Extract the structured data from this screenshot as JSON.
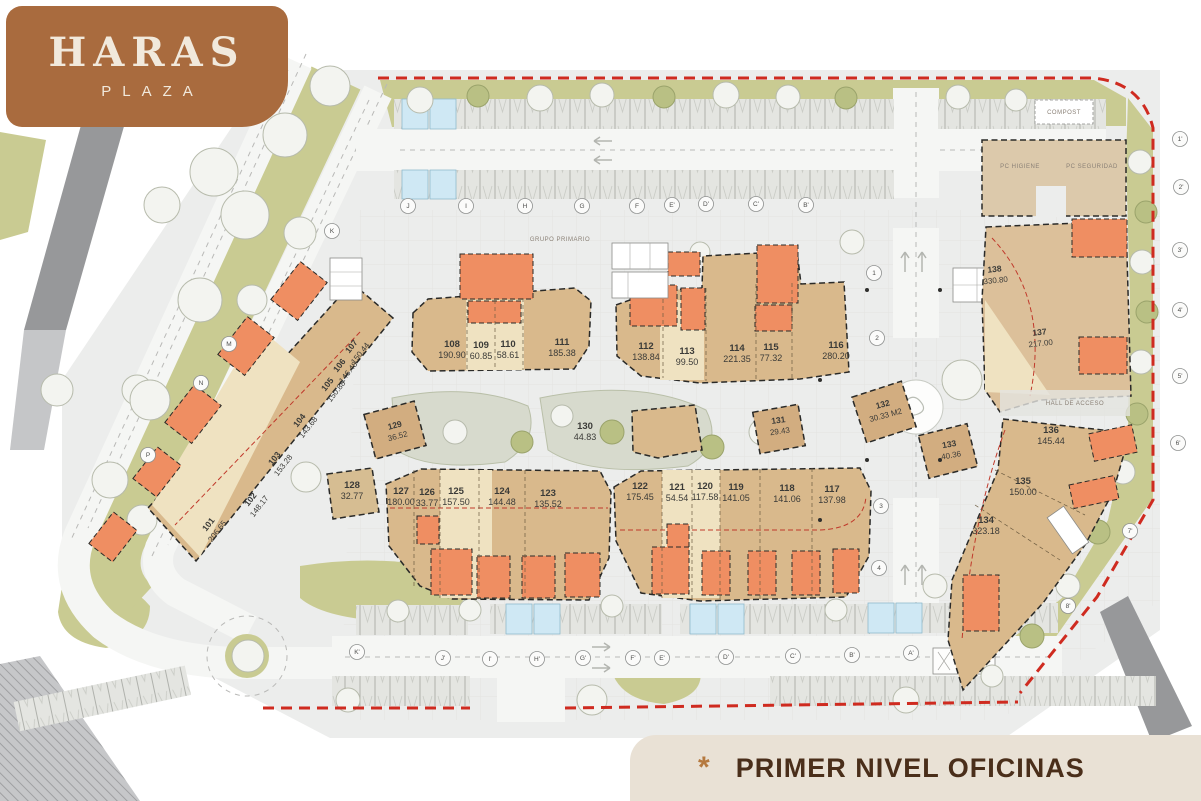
{
  "brand": {
    "title": "HARAS",
    "subtitle": "PLAZA"
  },
  "footer": {
    "marker": "*",
    "label": "PRIMER NIVEL OFICINAS"
  },
  "plan": {
    "annotations": {
      "hall": "HALL DE ACCESO",
      "grupo": "GRUPO PRIMARIO",
      "compost": "COMPOST",
      "pc1": "PC HIGIENE",
      "pc2": "PC SEGURIDAD"
    },
    "units": [
      {
        "id": "101",
        "area": "206.65"
      },
      {
        "id": "102",
        "area": "148.17"
      },
      {
        "id": "103",
        "area": "153.28"
      },
      {
        "id": "104",
        "area": "143.68"
      },
      {
        "id": "105",
        "area": "150.88"
      },
      {
        "id": "106",
        "area": "146.48"
      },
      {
        "id": "107",
        "area": "150.44"
      },
      {
        "id": "108",
        "area": "190.90"
      },
      {
        "id": "109",
        "area": "60.85"
      },
      {
        "id": "110",
        "area": "58.61"
      },
      {
        "id": "111",
        "area": "185.38"
      },
      {
        "id": "112",
        "area": "138.84"
      },
      {
        "id": "113",
        "area": "99.50"
      },
      {
        "id": "114",
        "area": "221.35"
      },
      {
        "id": "115",
        "area": "77.32"
      },
      {
        "id": "116",
        "area": "280.20"
      },
      {
        "id": "117",
        "area": "137.98"
      },
      {
        "id": "118",
        "area": "141.06"
      },
      {
        "id": "119",
        "area": "141.05"
      },
      {
        "id": "120",
        "area": "117.58"
      },
      {
        "id": "121",
        "area": "54.54"
      },
      {
        "id": "122",
        "area": "175.45"
      },
      {
        "id": "123",
        "area": "135.52"
      },
      {
        "id": "124",
        "area": "144.48"
      },
      {
        "id": "125",
        "area": "157.50"
      },
      {
        "id": "126",
        "area": "33.77"
      },
      {
        "id": "127",
        "area": "180.00"
      },
      {
        "id": "128",
        "area": "32.77"
      },
      {
        "id": "129",
        "area": "36.52"
      },
      {
        "id": "130",
        "area": "44.83"
      },
      {
        "id": "131",
        "area": "29.43"
      },
      {
        "id": "132",
        "area": "30.33 M2"
      },
      {
        "id": "133",
        "area": "40.36"
      },
      {
        "id": "134",
        "area": "323.18"
      },
      {
        "id": "135",
        "area": "150.00"
      },
      {
        "id": "136",
        "area": "145.44"
      },
      {
        "id": "137",
        "area": "217.00"
      },
      {
        "id": "138",
        "area": "330.80"
      }
    ],
    "grid": {
      "top": [
        "J",
        "I",
        "H",
        "G",
        "F",
        "E'",
        "D'",
        "C'",
        "B'"
      ],
      "bottom": [
        "K'",
        "J'",
        "I'",
        "H'",
        "G'",
        "F'",
        "E'",
        "D'",
        "C'",
        "B'",
        "A'"
      ],
      "left": [
        "K",
        "M",
        "N",
        "P"
      ],
      "right": [
        "1'",
        "2'",
        "3'",
        "4'",
        "5'",
        "6'",
        "7'",
        "8'"
      ],
      "center": [
        "1",
        "2",
        "3",
        "4"
      ]
    },
    "colors": {
      "boundary_red": "#CF2B20",
      "terrace_orange": "#EF8E62",
      "building_tan": "#D9B98C",
      "building_light": "#EFE2C1",
      "landscape_olive": "#C9CB92",
      "brand_brown": "#A96B3E",
      "footer_bg": "#E9E1D5"
    }
  }
}
